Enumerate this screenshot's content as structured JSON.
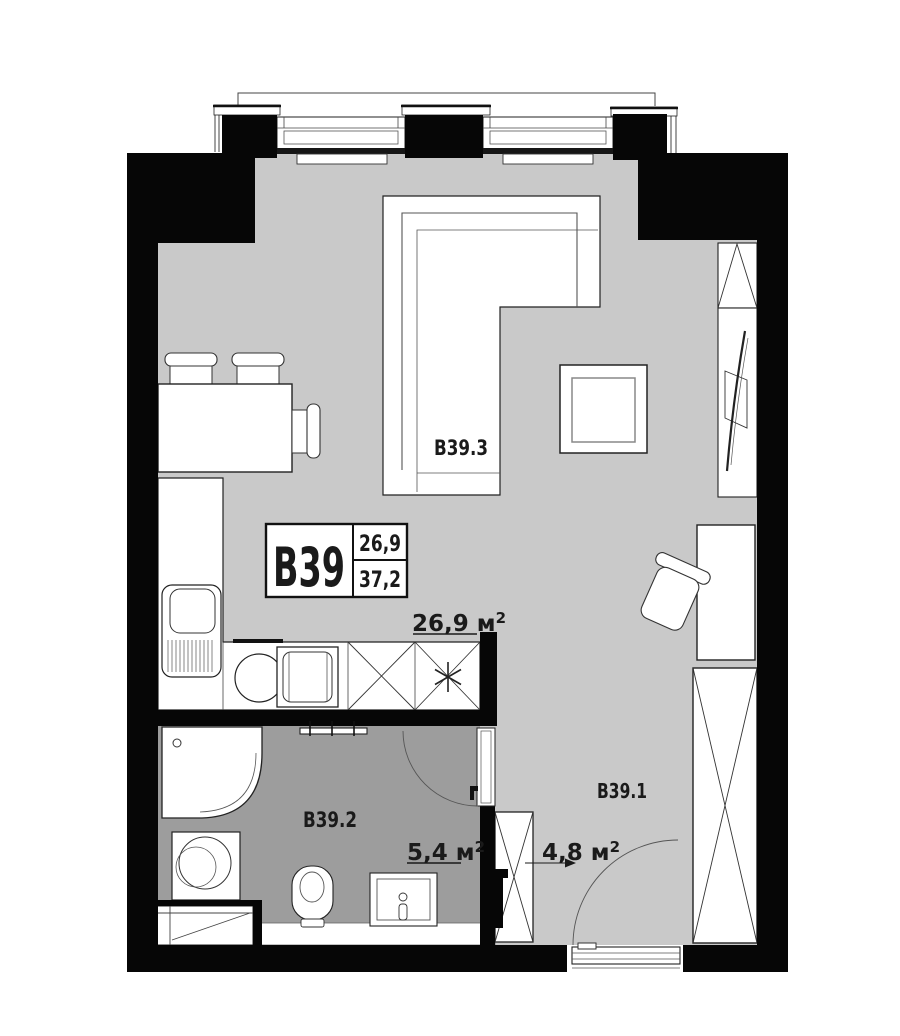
{
  "unit_card": {
    "id": "B39",
    "value_top": "26,9",
    "value_bottom": "37,2"
  },
  "room_labels": {
    "living": "B39.3",
    "bathroom": "B39.2",
    "hallway": "B39.1"
  },
  "area_labels": {
    "living": {
      "value": "26,9 м",
      "sup": "2"
    },
    "bathroom": {
      "value": "5,4 м",
      "sup": "2"
    },
    "hallway": {
      "value": "4,8 м",
      "sup": "2"
    }
  },
  "colors": {
    "wall": "#060606",
    "floor_main": "#c9c9c9",
    "floor_bathroom": "#9d9d9d",
    "text": "#1a1a1a"
  }
}
